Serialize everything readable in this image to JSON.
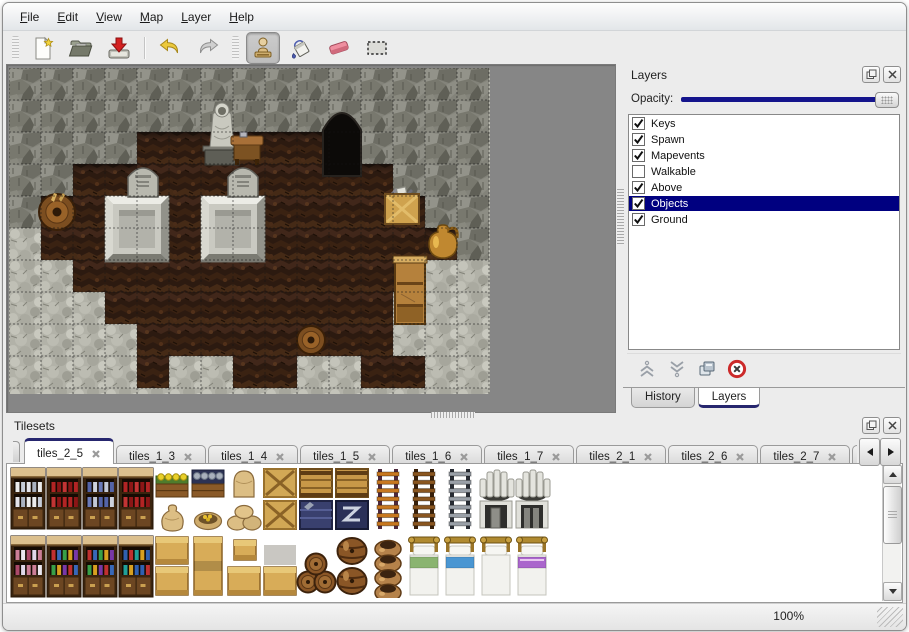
{
  "menu": {
    "items": [
      "File",
      "Edit",
      "View",
      "Map",
      "Layer",
      "Help"
    ]
  },
  "toolbar": {
    "toolbars": [
      {
        "buttons": [
          "new",
          "open",
          "save",
          "separator",
          "undo",
          "redo"
        ]
      },
      {
        "buttons": [
          "stamp",
          "fill",
          "eraser",
          "select"
        ],
        "active": "stamp"
      }
    ]
  },
  "map_view": {
    "tile_size": 32,
    "grid": [
      "WWWWWWWWWWWWWWW",
      "WWWWWWWWWWDWWWW",
      "WWWWFFFFFFDWWWW",
      "WWFFFFFFFFFFWWW",
      "WFFFFFFFFFFFFWW",
      "RFFFFFFFFFFFFFW",
      "RRFFFFFFFFFFFRR",
      "RRRFFFFFFFFFRRR",
      "RRRRFFFFFFFFRRR",
      "RRRRFRRFFRRFFRR"
    ],
    "objects": [
      {
        "type": "door",
        "x": 314,
        "y": 36,
        "w": 38,
        "h": 72
      },
      {
        "type": "platform",
        "x": 96,
        "y": 128
      },
      {
        "type": "platform",
        "x": 192,
        "y": 128
      },
      {
        "type": "gravestone",
        "x": 119,
        "y": 95
      },
      {
        "type": "gravestone",
        "x": 219,
        "y": 95
      },
      {
        "type": "statue",
        "x": 194,
        "y": 30
      },
      {
        "type": "table",
        "x": 222,
        "y": 64
      },
      {
        "type": "crate",
        "x": 374,
        "y": 118
      },
      {
        "type": "pot",
        "x": 414,
        "y": 154
      },
      {
        "type": "wallshelf",
        "x": 384,
        "y": 188
      },
      {
        "type": "barrel",
        "x": 30,
        "y": 126,
        "w": 36
      },
      {
        "type": "barrel",
        "x": 288,
        "y": 258,
        "w": 28
      }
    ]
  },
  "layers_panel": {
    "title": "Layers",
    "opacity_label": "Opacity:",
    "opacity_percent": 100,
    "layers": [
      {
        "name": "Keys",
        "checked": true,
        "selected": false
      },
      {
        "name": "Spawn",
        "checked": true,
        "selected": false
      },
      {
        "name": "Mapevents",
        "checked": true,
        "selected": false
      },
      {
        "name": "Walkable",
        "checked": false,
        "selected": false
      },
      {
        "name": "Above",
        "checked": true,
        "selected": false
      },
      {
        "name": "Objects",
        "checked": true,
        "selected": true
      },
      {
        "name": "Ground",
        "checked": true,
        "selected": false
      }
    ],
    "tool_buttons": [
      "raise",
      "lower",
      "duplicate",
      "delete"
    ],
    "tabs": [
      {
        "label": "History",
        "active": false
      },
      {
        "label": "Layers",
        "active": true
      }
    ]
  },
  "tilesets_panel": {
    "title": "Tilesets",
    "left_clipped_tab": true,
    "tabs": [
      {
        "label": "tiles_2_5",
        "active": true,
        "closable": true,
        "clipped": false
      },
      {
        "label": "tiles_1_3",
        "active": false,
        "closable": true,
        "clipped": false
      },
      {
        "label": "tiles_1_4",
        "active": false,
        "closable": true,
        "clipped": false
      },
      {
        "label": "tiles_1_5",
        "active": false,
        "closable": true,
        "clipped": false
      },
      {
        "label": "tiles_1_6",
        "active": false,
        "closable": true,
        "clipped": false
      },
      {
        "label": "tiles_1_7",
        "active": false,
        "closable": true,
        "clipped": false
      },
      {
        "label": "tiles_2_1",
        "active": false,
        "closable": true,
        "clipped": false
      },
      {
        "label": "tiles_2_6",
        "active": false,
        "closable": true,
        "clipped": false
      },
      {
        "label": "tiles_2_7",
        "active": false,
        "closable": true,
        "clipped": false
      },
      {
        "label": "tiles_",
        "active": false,
        "closable": false,
        "clipped": true
      }
    ],
    "content_top": [
      "shelf.white",
      "shelf.red",
      "shelf.bluepots",
      "shelf.red",
      "planter.yellow|sack",
      "planter.blue|sackopen",
      "sacktall|sackpile",
      "cratex|cratex",
      "crateplanks|crateblue",
      "crateplanks|cratez",
      "ladder.orange",
      "ladder.brown",
      "ladder.gray",
      "hearth.a",
      "hearth.b"
    ],
    "content_bottom": [
      "shelf.potions",
      "shelf.books",
      "shelf.books",
      "shelf.books2",
      "counter.double",
      "counter.tall",
      "counter.step",
      "counter.low",
      "barrelpile",
      "barrels2",
      "potstack",
      "bed.green",
      "bed.blue",
      "bed.plain",
      "bed.purple"
    ]
  },
  "status_bar": {
    "zoom": "100%"
  },
  "colors": {
    "selection_blue": "#000080",
    "tab_accent": "#26266e",
    "opacity_track": "#14148c"
  }
}
